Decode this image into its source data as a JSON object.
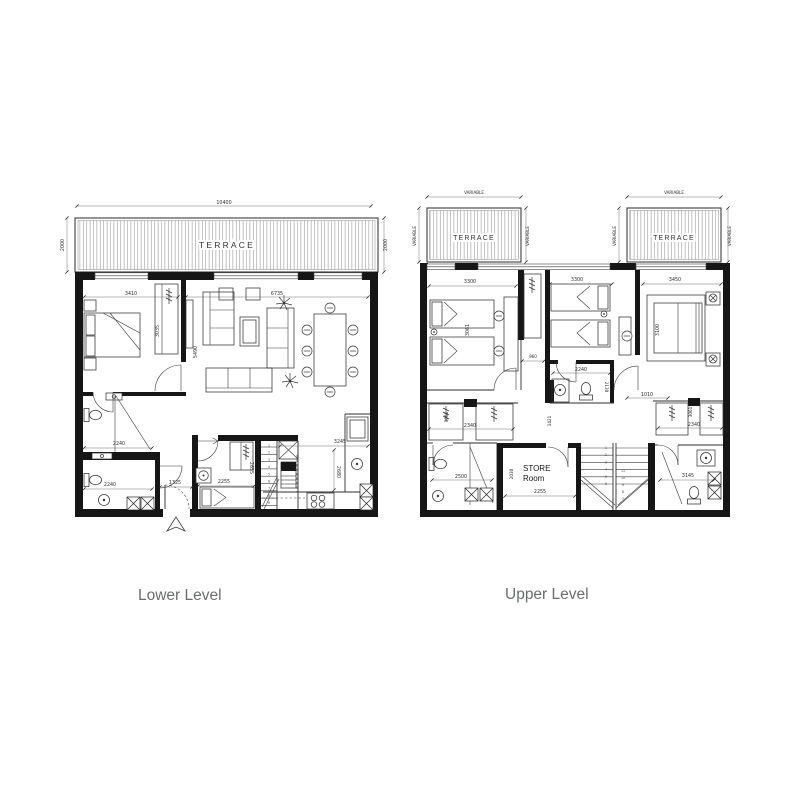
{
  "drawing": {
    "background": "#ffffff",
    "wall_color": "#161616",
    "label_color": "#6a6c6e"
  },
  "plans": {
    "lower": {
      "title": "Lower Level",
      "terrace": {
        "label": "TERRACE"
      },
      "dims": {
        "terrace_width": "10400",
        "terrace_depth_left": "2000",
        "terrace_depth_right": "2000",
        "bedroom_width": "3410",
        "living_width": "6735",
        "bedroom_depth": "3035",
        "living_depth": "5490",
        "bathroom1_width": "2240",
        "bathroom2_width": "2240",
        "entry_width": "1325",
        "maid_room_width": "2255",
        "maid_room_depth": "2655",
        "kitchen_width": "3245",
        "kitchen_depth": "2680"
      },
      "stair_numbers": [
        "1",
        "2",
        "3",
        "4",
        "5",
        "6",
        "7",
        "8",
        "9"
      ]
    },
    "upper": {
      "title": "Upper Level",
      "terrace_left": {
        "label": "TERRACE"
      },
      "terrace_right": {
        "label": "TERRACE"
      },
      "store_room": {
        "line1": "STORE",
        "line2": "Room"
      },
      "dims": {
        "terrace_left_width": "VARIABLE",
        "terrace_left_depth_a": "VARIABLE",
        "terrace_left_depth_b": "VARIABLE",
        "terrace_right_width": "VARIABLE",
        "terrace_right_depth_a": "VARIABLE",
        "terrace_right_depth_b": "VARIABLE",
        "bedroom1_width": "3300",
        "bedroom2_width": "3300",
        "master_width": "3450",
        "bedroom1_depth": "3061",
        "master_depth": "3100",
        "hall_width": "960",
        "bathroom_mid_width": "2240",
        "bathroom_mid_depth": "2130",
        "hall2_width": "1010",
        "hall_depth": "1421",
        "closets_left_width": "2340",
        "closet_left_depth": "3061",
        "bathroom_left_width": "2500",
        "store_width": "2255",
        "store_depth": "2030",
        "closets_right_width": "2340",
        "closet_right_depth": "3061",
        "bathroom_right_width": "3145"
      },
      "stair_numbers": [
        "1",
        "2",
        "3",
        "4",
        "5",
        "6",
        "7",
        "8",
        "9",
        "10",
        "11"
      ]
    }
  }
}
